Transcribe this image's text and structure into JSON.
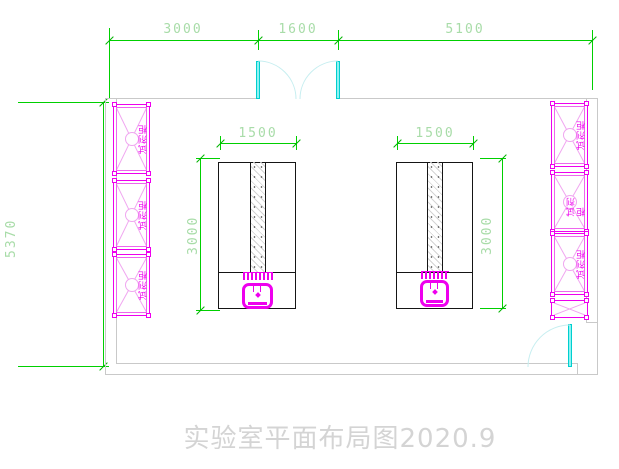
{
  "title": "实验室平面布局图2020.9",
  "dimensions": {
    "top_left": "3000",
    "top_middle": "1600",
    "top_right": "5100",
    "left_total": "5370",
    "bench_left_width": "1500",
    "bench_left_height": "3000",
    "bench_right_width": "1500",
    "bench_right_height": "3000"
  },
  "cabinets": {
    "left": [
      {
        "label": "试剂柜"
      },
      {
        "label": "试剂柜"
      },
      {
        "label": "试剂柜"
      }
    ],
    "right": [
      {
        "label": "试剂柜"
      },
      {
        "label": "试剂柜"
      },
      {
        "label": "试剂柜"
      }
    ]
  },
  "colors": {
    "dimension_line": "#00d000",
    "dimension_text": "#a8dca8",
    "cabinet_magenta": "#ee00ee",
    "door_cyan": "#00cfcf",
    "wall_gray": "#c9c9c9",
    "bench_outline": "#151515",
    "title_gray": "#d4d4d4"
  }
}
